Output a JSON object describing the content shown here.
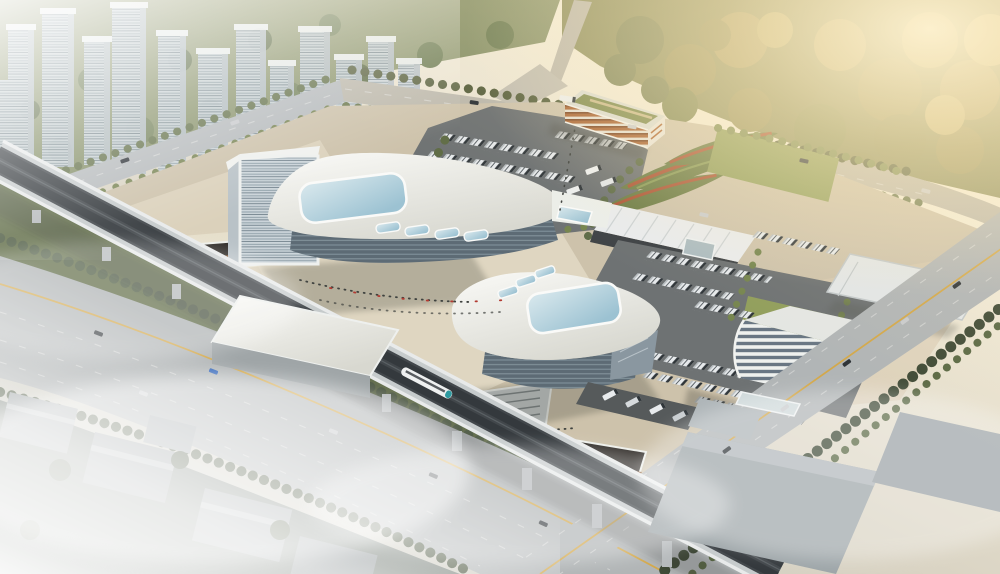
{
  "scene": {
    "title": "Aerial rendering of a modern transit hub",
    "type": "architectural-aerial-rendering",
    "lighting": "hazy morning, warm sun glow from upper right, fog over lower left district",
    "features": [
      "two white curved terminal buildings with large pale-blue skylights",
      "attached louvered office tower on west terminal",
      "north bus parking lot with angled bus rows and orange-banded office block with green roof",
      "east bus depot with bus rows, lawns, flat equipment canopy and curved white office building",
      "landscaped berms with red flower stripes and long maintenance shed",
      "elevated rail viaduct crossing the site with a train and track shed",
      "sunken entry courtyards with escalators and crowds of tiny people",
      "hazy residential towers upper left, golden forest park upper right",
      "wide arterial roads with yellow center lines, cars, and foggy warehouse district at bottom"
    ]
  },
  "palette": {
    "sky_warm": "#f6eedb",
    "sun_glow": "#ffefc2",
    "haze_white": "#ffffff",
    "city_tower_face": "#dce2e6",
    "city_tower_side": "#c2cacf",
    "tree_dark": "#4f5c3d",
    "tree_mid": "#6e7c50",
    "tree_bright": "#8a9a5e",
    "forest_olive": "#8f9060",
    "forest_gold": "#b4a76e",
    "lawn": "#919e5c",
    "plaza": "#cdc2ab",
    "plaza_light": "#e2d9c4",
    "asphalt": "#6e7273",
    "road": "#b1b5b6",
    "road_warm": "#bcb8ac",
    "lane_yellow": "#d7a63e",
    "lane_white": "#e7e8e5",
    "terminal_white": "#f2f2ee",
    "facade_glass": "#5d6b75",
    "skylight_blue_light": "#c6dde6",
    "skylight_blue_deep": "#97bfd0",
    "office_band_orange": "#a96434",
    "office_white": "#eef0ee",
    "viaduct_concrete": "#c6cbcc",
    "track_bed": "#42474b",
    "train_teal": "#2e9aa0",
    "berm_green": "#6d7c46",
    "berm_red": "#ac5637",
    "pit_wall_warm": "#8a5a33",
    "warehouse_grey": "#9da5a8",
    "fog": "#ffffff"
  },
  "inventory": {
    "residential_towers": 13,
    "terminal_buildings": 2,
    "office_buildings": 2,
    "large_skylights": 2,
    "bus_parking_rows": 14,
    "canopy_structures": 2,
    "sunken_courtyards": 2,
    "elevated_rail_viaducts": 1,
    "trains": 1,
    "arterial_roads": 3
  }
}
